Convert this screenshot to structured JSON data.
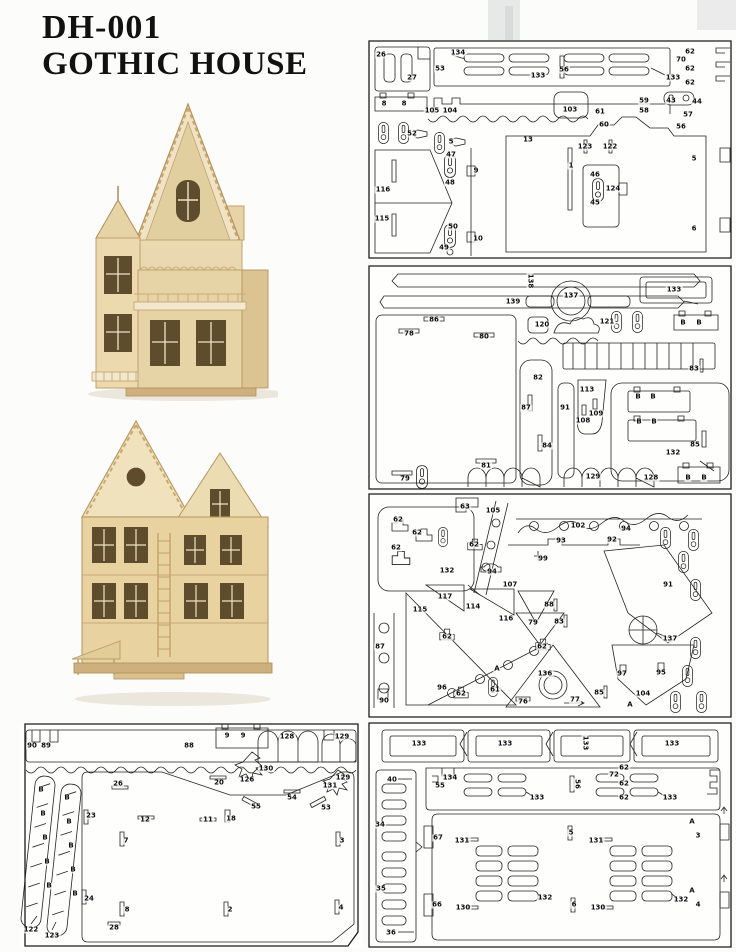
{
  "title": {
    "line1": "DH-001",
    "line2": "GOTHIC HOUSE"
  },
  "colors": {
    "line": "#222222",
    "wood_light": "#efe2c2",
    "wood_mid": "#e6d3a6",
    "wood_dark": "#5f4c2c",
    "trim": "#bfa06c",
    "page_bg": "#fcfcfa"
  },
  "panels": {
    "sheetA": {
      "labels": [
        {
          "t": "26",
          "x": 13,
          "y": 15
        },
        {
          "t": "27",
          "x": 44,
          "y": 38
        },
        {
          "t": "53",
          "x": 72,
          "y": 29
        },
        {
          "t": "134",
          "x": 90,
          "y": 13
        },
        {
          "t": "133",
          "x": 170,
          "y": 36
        },
        {
          "t": "56",
          "x": 196,
          "y": 30
        },
        {
          "t": "133",
          "x": 305,
          "y": 38
        },
        {
          "t": "62",
          "x": 322,
          "y": 12
        },
        {
          "t": "70",
          "x": 313,
          "y": 20
        },
        {
          "t": "62",
          "x": 322,
          "y": 29
        },
        {
          "t": "62",
          "x": 322,
          "y": 43
        },
        {
          "t": "8",
          "x": 16,
          "y": 64
        },
        {
          "t": "8",
          "x": 36,
          "y": 64
        },
        {
          "t": "105",
          "x": 64,
          "y": 71
        },
        {
          "t": "104",
          "x": 82,
          "y": 71
        },
        {
          "t": "52",
          "x": 44,
          "y": 94
        },
        {
          "t": "5",
          "x": 83,
          "y": 102
        },
        {
          "t": "13",
          "x": 160,
          "y": 100
        },
        {
          "t": "103",
          "x": 202,
          "y": 70
        },
        {
          "t": "61",
          "x": 232,
          "y": 72
        },
        {
          "t": "60",
          "x": 236,
          "y": 85
        },
        {
          "t": "59",
          "x": 276,
          "y": 61
        },
        {
          "t": "58",
          "x": 276,
          "y": 71
        },
        {
          "t": "43",
          "x": 303,
          "y": 61
        },
        {
          "t": "44",
          "x": 329,
          "y": 62
        },
        {
          "t": "57",
          "x": 320,
          "y": 75
        },
        {
          "t": "56",
          "x": 313,
          "y": 87
        },
        {
          "t": "123",
          "x": 217,
          "y": 107
        },
        {
          "t": "122",
          "x": 242,
          "y": 107
        },
        {
          "t": "47",
          "x": 83,
          "y": 115
        },
        {
          "t": "48",
          "x": 82,
          "y": 143
        },
        {
          "t": "9",
          "x": 108,
          "y": 131
        },
        {
          "t": "116",
          "x": 15,
          "y": 150
        },
        {
          "t": "115",
          "x": 14,
          "y": 179
        },
        {
          "t": "50",
          "x": 85,
          "y": 187
        },
        {
          "t": "49",
          "x": 76,
          "y": 208
        },
        {
          "t": "10",
          "x": 110,
          "y": 199
        },
        {
          "t": "1",
          "x": 203,
          "y": 126
        },
        {
          "t": "46",
          "x": 227,
          "y": 135
        },
        {
          "t": "45",
          "x": 227,
          "y": 163
        },
        {
          "t": "124",
          "x": 245,
          "y": 149
        },
        {
          "t": "5",
          "x": 326,
          "y": 119
        },
        {
          "t": "6",
          "x": 326,
          "y": 189
        }
      ]
    },
    "sheetB": {
      "labels": [
        {
          "t": "138",
          "x": 162,
          "y": 16,
          "r": 90
        },
        {
          "t": "139",
          "x": 145,
          "y": 37
        },
        {
          "t": "86",
          "x": 66,
          "y": 55
        },
        {
          "t": "78",
          "x": 41,
          "y": 69
        },
        {
          "t": "80",
          "x": 116,
          "y": 72
        },
        {
          "t": "120",
          "x": 174,
          "y": 60
        },
        {
          "t": "137",
          "x": 203,
          "y": 31
        },
        {
          "t": "133",
          "x": 306,
          "y": 25
        },
        {
          "t": "121",
          "x": 239,
          "y": 57
        },
        {
          "t": "B",
          "x": 315,
          "y": 58
        },
        {
          "t": "B",
          "x": 331,
          "y": 58
        },
        {
          "t": "83",
          "x": 326,
          "y": 104
        },
        {
          "t": "82",
          "x": 170,
          "y": 113
        },
        {
          "t": "87",
          "x": 158,
          "y": 143
        },
        {
          "t": "84",
          "x": 179,
          "y": 181
        },
        {
          "t": "91",
          "x": 197,
          "y": 143
        },
        {
          "t": "113",
          "x": 219,
          "y": 125
        },
        {
          "t": "108",
          "x": 215,
          "y": 156
        },
        {
          "t": "109",
          "x": 228,
          "y": 149
        },
        {
          "t": "132",
          "x": 305,
          "y": 188
        },
        {
          "t": "B",
          "x": 270,
          "y": 132
        },
        {
          "t": "B",
          "x": 285,
          "y": 132
        },
        {
          "t": "B",
          "x": 271,
          "y": 157
        },
        {
          "t": "B",
          "x": 286,
          "y": 157
        },
        {
          "t": "85",
          "x": 327,
          "y": 180
        },
        {
          "t": "129",
          "x": 225,
          "y": 212
        },
        {
          "t": "128",
          "x": 283,
          "y": 213
        },
        {
          "t": "B",
          "x": 320,
          "y": 213
        },
        {
          "t": "B",
          "x": 336,
          "y": 213
        },
        {
          "t": "79",
          "x": 37,
          "y": 214
        },
        {
          "t": "81",
          "x": 118,
          "y": 201
        }
      ]
    },
    "sheetC": {
      "labels": [
        {
          "t": "62",
          "x": 30,
          "y": 27
        },
        {
          "t": "62",
          "x": 49,
          "y": 40
        },
        {
          "t": "62",
          "x": 28,
          "y": 55
        },
        {
          "t": "132",
          "x": 79,
          "y": 78
        },
        {
          "t": "63",
          "x": 97,
          "y": 14
        },
        {
          "t": "62",
          "x": 106,
          "y": 52
        },
        {
          "t": "94",
          "x": 124,
          "y": 79
        },
        {
          "t": "105",
          "x": 125,
          "y": 18
        },
        {
          "t": "107",
          "x": 142,
          "y": 92
        },
        {
          "t": "99",
          "x": 175,
          "y": 66
        },
        {
          "t": "117",
          "x": 77,
          "y": 104
        },
        {
          "t": "102",
          "x": 210,
          "y": 33
        },
        {
          "t": "93",
          "x": 193,
          "y": 48
        },
        {
          "t": "92",
          "x": 244,
          "y": 47
        },
        {
          "t": "94",
          "x": 258,
          "y": 36
        },
        {
          "t": "91",
          "x": 300,
          "y": 92
        },
        {
          "t": "115",
          "x": 52,
          "y": 117
        },
        {
          "t": "114",
          "x": 105,
          "y": 114
        },
        {
          "t": "116",
          "x": 138,
          "y": 126
        },
        {
          "t": "87",
          "x": 12,
          "y": 154
        },
        {
          "t": "62",
          "x": 79,
          "y": 144
        },
        {
          "t": "96",
          "x": 74,
          "y": 195
        },
        {
          "t": "90",
          "x": 16,
          "y": 208
        },
        {
          "t": "62",
          "x": 93,
          "y": 201
        },
        {
          "t": "61",
          "x": 127,
          "y": 197
        },
        {
          "t": "79",
          "x": 165,
          "y": 130
        },
        {
          "t": "76",
          "x": 155,
          "y": 209
        },
        {
          "t": "136",
          "x": 177,
          "y": 181
        },
        {
          "t": "62",
          "x": 174,
          "y": 154
        },
        {
          "t": "83",
          "x": 191,
          "y": 129
        },
        {
          "t": "88",
          "x": 181,
          "y": 112
        },
        {
          "t": "137",
          "x": 302,
          "y": 146
        },
        {
          "t": "97",
          "x": 254,
          "y": 181
        },
        {
          "t": "95",
          "x": 293,
          "y": 180
        },
        {
          "t": "104",
          "x": 275,
          "y": 201
        },
        {
          "t": "85",
          "x": 231,
          "y": 200
        },
        {
          "t": "77",
          "x": 207,
          "y": 207
        },
        {
          "t": "A",
          "x": 129,
          "y": 176
        },
        {
          "t": "A",
          "x": 262,
          "y": 212
        }
      ]
    },
    "sheetD": {
      "labels": [
        {
          "t": "90",
          "x": 12,
          "y": 24
        },
        {
          "t": "89",
          "x": 26,
          "y": 24
        },
        {
          "t": "88",
          "x": 169,
          "y": 24
        },
        {
          "t": "9",
          "x": 207,
          "y": 14
        },
        {
          "t": "9",
          "x": 223,
          "y": 14
        },
        {
          "t": "128",
          "x": 267,
          "y": 15
        },
        {
          "t": "129",
          "x": 322,
          "y": 15
        },
        {
          "t": "26",
          "x": 98,
          "y": 62
        },
        {
          "t": "130",
          "x": 246,
          "y": 47
        },
        {
          "t": "126",
          "x": 227,
          "y": 58
        },
        {
          "t": "20",
          "x": 199,
          "y": 61
        },
        {
          "t": "131",
          "x": 310,
          "y": 64
        },
        {
          "t": "129",
          "x": 323,
          "y": 56
        },
        {
          "t": "23",
          "x": 71,
          "y": 94
        },
        {
          "t": "12",
          "x": 125,
          "y": 98
        },
        {
          "t": "54",
          "x": 272,
          "y": 76
        },
        {
          "t": "55",
          "x": 236,
          "y": 85
        },
        {
          "t": "53",
          "x": 306,
          "y": 86
        },
        {
          "t": "11",
          "x": 188,
          "y": 98
        },
        {
          "t": "18",
          "x": 211,
          "y": 97
        },
        {
          "t": "7",
          "x": 106,
          "y": 119
        },
        {
          "t": "3",
          "x": 322,
          "y": 119
        },
        {
          "t": "24",
          "x": 69,
          "y": 177
        },
        {
          "t": "8",
          "x": 107,
          "y": 188
        },
        {
          "t": "2",
          "x": 210,
          "y": 188
        },
        {
          "t": "4",
          "x": 321,
          "y": 186
        },
        {
          "t": "28",
          "x": 94,
          "y": 206
        },
        {
          "t": "122",
          "x": 11,
          "y": 208
        },
        {
          "t": "123",
          "x": 32,
          "y": 214
        },
        {
          "t": "B",
          "x": 21,
          "y": 68
        },
        {
          "t": "B",
          "x": 23,
          "y": 92
        },
        {
          "t": "B",
          "x": 25,
          "y": 116
        },
        {
          "t": "B",
          "x": 27,
          "y": 140
        },
        {
          "t": "B",
          "x": 29,
          "y": 164
        },
        {
          "t": "B",
          "x": 47,
          "y": 76
        },
        {
          "t": "B",
          "x": 49,
          "y": 100
        },
        {
          "t": "B",
          "x": 51,
          "y": 124
        },
        {
          "t": "B",
          "x": 53,
          "y": 148
        },
        {
          "t": "B",
          "x": 55,
          "y": 172
        }
      ]
    },
    "sheetE": {
      "labels": [
        {
          "t": "133",
          "x": 51,
          "y": 22
        },
        {
          "t": "133",
          "x": 137,
          "y": 22
        },
        {
          "t": "133",
          "x": 217,
          "y": 21,
          "r": 90
        },
        {
          "t": "133",
          "x": 304,
          "y": 22
        },
        {
          "t": "40",
          "x": 24,
          "y": 58
        },
        {
          "t": "134",
          "x": 82,
          "y": 56
        },
        {
          "t": "55",
          "x": 72,
          "y": 64
        },
        {
          "t": "133",
          "x": 169,
          "y": 76
        },
        {
          "t": "56",
          "x": 209,
          "y": 62,
          "r": 90
        },
        {
          "t": "72",
          "x": 246,
          "y": 53
        },
        {
          "t": "62",
          "x": 256,
          "y": 46
        },
        {
          "t": "62",
          "x": 256,
          "y": 62
        },
        {
          "t": "62",
          "x": 256,
          "y": 76
        },
        {
          "t": "133",
          "x": 302,
          "y": 76
        },
        {
          "t": "34",
          "x": 12,
          "y": 103
        },
        {
          "t": "35",
          "x": 13,
          "y": 167
        },
        {
          "t": "36",
          "x": 23,
          "y": 211
        },
        {
          "t": "67",
          "x": 70,
          "y": 116
        },
        {
          "t": "66",
          "x": 69,
          "y": 183
        },
        {
          "t": "131",
          "x": 94,
          "y": 119
        },
        {
          "t": "130",
          "x": 95,
          "y": 186
        },
        {
          "t": "132",
          "x": 177,
          "y": 176
        },
        {
          "t": "5",
          "x": 203,
          "y": 111
        },
        {
          "t": "131",
          "x": 228,
          "y": 119
        },
        {
          "t": "132",
          "x": 313,
          "y": 178
        },
        {
          "t": "130",
          "x": 230,
          "y": 186
        },
        {
          "t": "6",
          "x": 206,
          "y": 183
        },
        {
          "t": "3",
          "x": 330,
          "y": 114
        },
        {
          "t": "4",
          "x": 330,
          "y": 183
        },
        {
          "t": "A",
          "x": 324,
          "y": 100
        },
        {
          "t": "A",
          "x": 324,
          "y": 169
        }
      ]
    }
  }
}
